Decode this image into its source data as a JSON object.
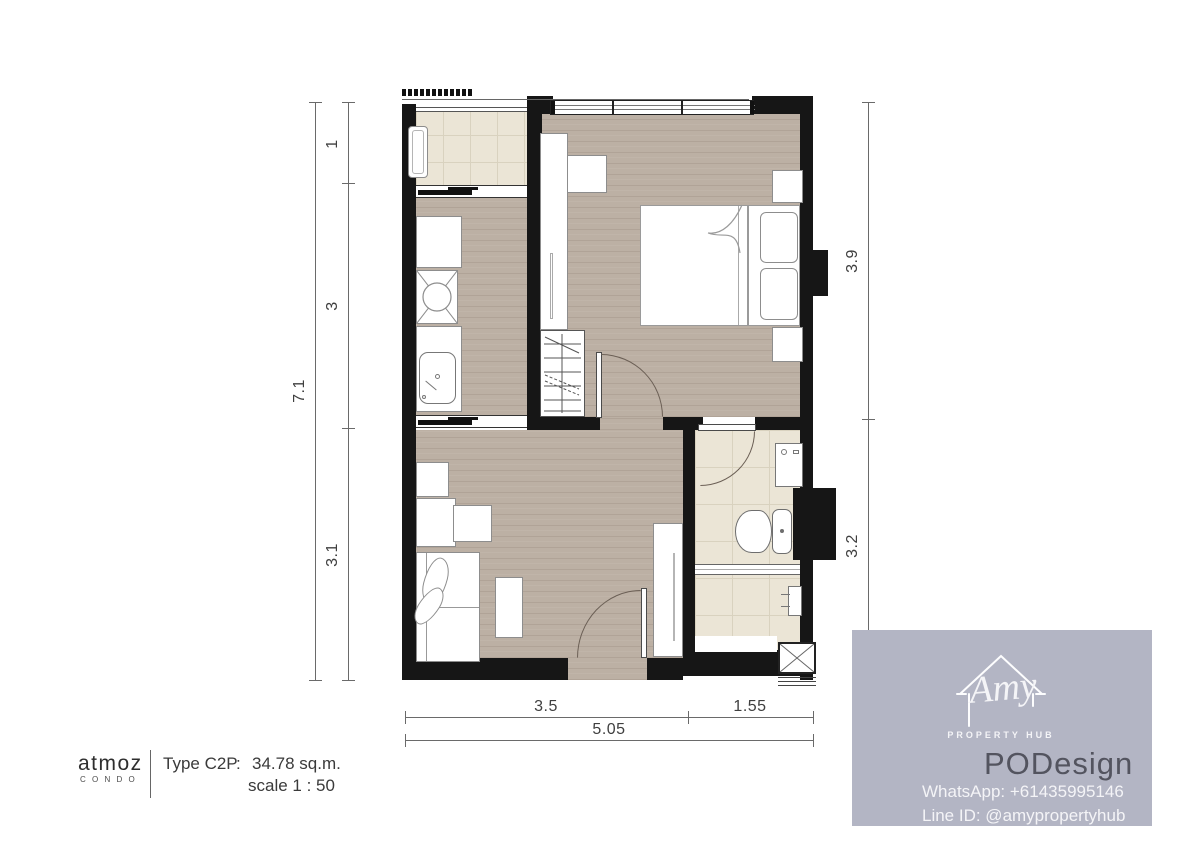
{
  "title_block": {
    "brand": "atmoz",
    "brand_sub": "C O N D O",
    "type_label": "Type C2P",
    "colon": ":",
    "area": "34.78 sq.m.",
    "scale": "scale 1 : 50"
  },
  "dimensions": {
    "left_total": "7.1",
    "left_segments": [
      "1",
      "3",
      "3.1"
    ],
    "right_segments": [
      "3.9",
      "3.2"
    ],
    "bottom_segments": [
      "3.5",
      "1.55"
    ],
    "bottom_total": "5.05"
  },
  "watermark": {
    "script_name": "Amy",
    "subtitle": "PROPERTY HUB",
    "studio": "PODesign",
    "whatsapp": "WhatsApp: +61435995146",
    "line_id": "Line ID: @amypropertyhub"
  },
  "colors": {
    "wall": "#161616",
    "wood_floor": "#bcb0a4",
    "tile_floor": "#ebe5d6",
    "tile_grid": "#d9d2bf",
    "watermark_bg": "#b3b5c4",
    "studio_text": "#53545f",
    "dim_text": "#3f3f3f"
  }
}
